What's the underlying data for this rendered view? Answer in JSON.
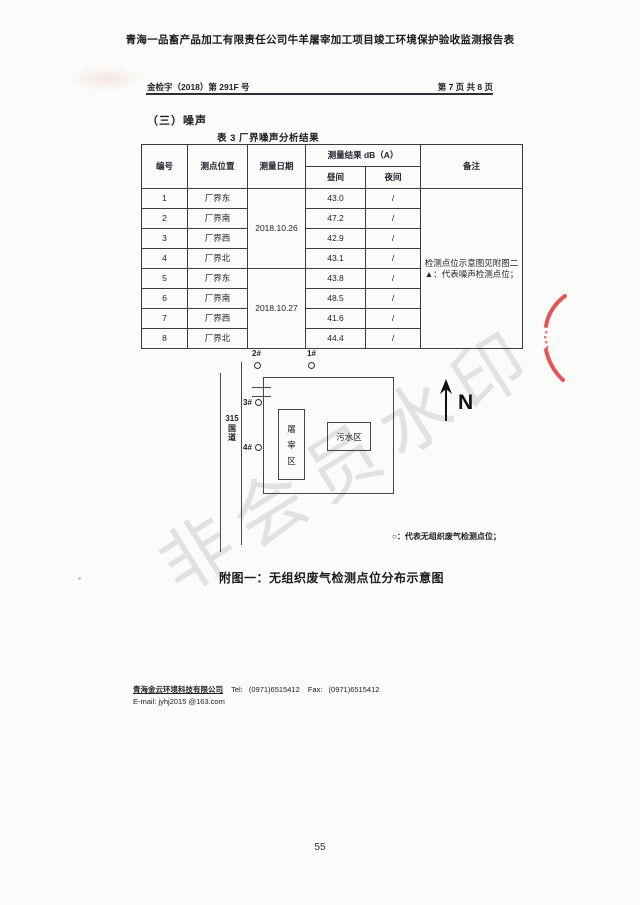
{
  "page": {
    "title": "青海一品畜产品加工有限责任公司牛羊屠宰加工项目竣工环境保护验收监测报告表",
    "doc_number": "金检字（2018）第 291F 号",
    "page_indicator": "第 7 页 共 8 页",
    "page_number": "55",
    "watermark": "非会员水印"
  },
  "section": {
    "heading": "（三）噪声",
    "table_title": "表 3  厂界噪声分析结果"
  },
  "noise_table": {
    "headers": {
      "id": "编号",
      "location": "测点位置",
      "date": "测量日期",
      "result": "测量结果 dB（A）",
      "day": "昼间",
      "night": "夜间",
      "remark": "备注"
    },
    "dates": [
      "2018.10.26",
      "2018.10.27"
    ],
    "rows": [
      {
        "id": "1",
        "location": "厂界东",
        "day": "43.0",
        "night": "/"
      },
      {
        "id": "2",
        "location": "厂界南",
        "day": "47.2",
        "night": "/"
      },
      {
        "id": "3",
        "location": "厂界西",
        "day": "42.9",
        "night": "/"
      },
      {
        "id": "4",
        "location": "厂界北",
        "day": "43.1",
        "night": "/"
      },
      {
        "id": "5",
        "location": "厂界东",
        "day": "43.8",
        "night": "/"
      },
      {
        "id": "6",
        "location": "厂界南",
        "day": "48.5",
        "night": "/"
      },
      {
        "id": "7",
        "location": "厂界西",
        "day": "41.6",
        "night": "/"
      },
      {
        "id": "8",
        "location": "厂界北",
        "day": "44.4",
        "night": "/"
      }
    ],
    "remark_lines": [
      "检测点位示意图见附图二",
      "▲：代表噪声检测点位；"
    ]
  },
  "diagram": {
    "road_label_lines": [
      "315",
      "国",
      "道"
    ],
    "points": {
      "p1": "1#",
      "p2": "2#",
      "p3": "3#",
      "p4": "4#"
    },
    "slaughter_area_chars": [
      "屠",
      "宰",
      "区"
    ],
    "sewage_area": "污水区",
    "north_label": "N",
    "legend": "○：代表无组织废气检测点位；",
    "caption": "附图一：无组织废气检测点位分布示意图"
  },
  "footer": {
    "company": "青海金云环境科技有限公司",
    "tel_label": "Tel:",
    "tel": "(0971)6515412",
    "fax_label": "Fax:",
    "fax": "(0971)6515412",
    "email_label": "E-mail:",
    "email": "jyhj2015 @163.com"
  }
}
